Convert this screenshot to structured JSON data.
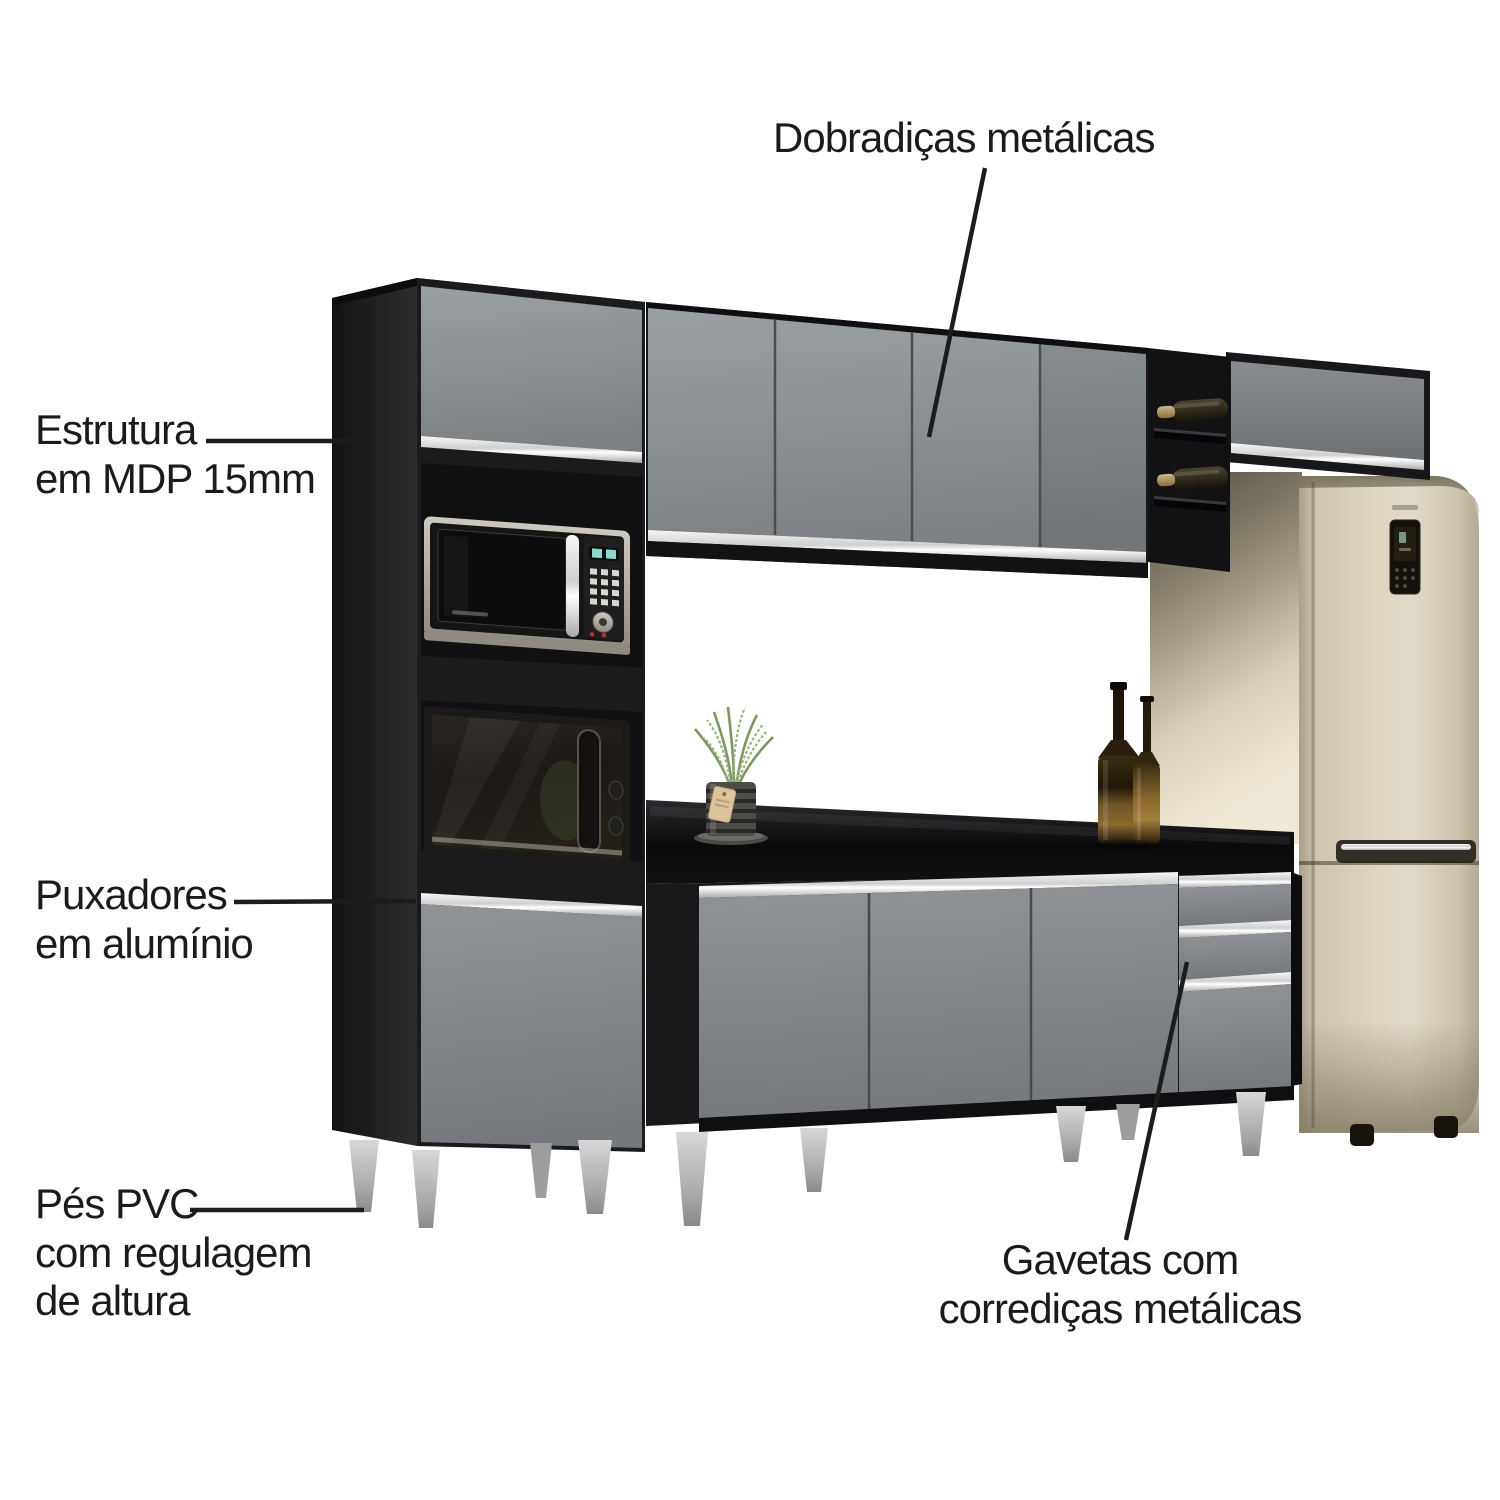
{
  "annotations": {
    "hinges": {
      "text": "Dobradiças metálicas"
    },
    "structure": {
      "line1": "Estrutura",
      "line2": "em MDP 15mm"
    },
    "handles": {
      "line1": "Puxadores",
      "line2": "em alumínio"
    },
    "feet": {
      "line1": "Pés PVC",
      "line2": "com regulagem",
      "line3": "de altura"
    },
    "drawers": {
      "line1": "Gavetas com",
      "line2": "corrediças metálicas"
    }
  },
  "colors": {
    "background": "#ffffff",
    "label_text": "#1b1b1b",
    "leader_line": "#1c1c1c",
    "carcass_black": "#1a1a1c",
    "door_gray": "#8c9093",
    "aluminum_handle": "#d9d9d9",
    "countertop_black": "#121214",
    "fridge_champagne": "#d6cdba",
    "feet_silver": "#b9b9b9",
    "wine_bottle_glass": "#3d3626",
    "plant_green": "#7d9a64"
  }
}
